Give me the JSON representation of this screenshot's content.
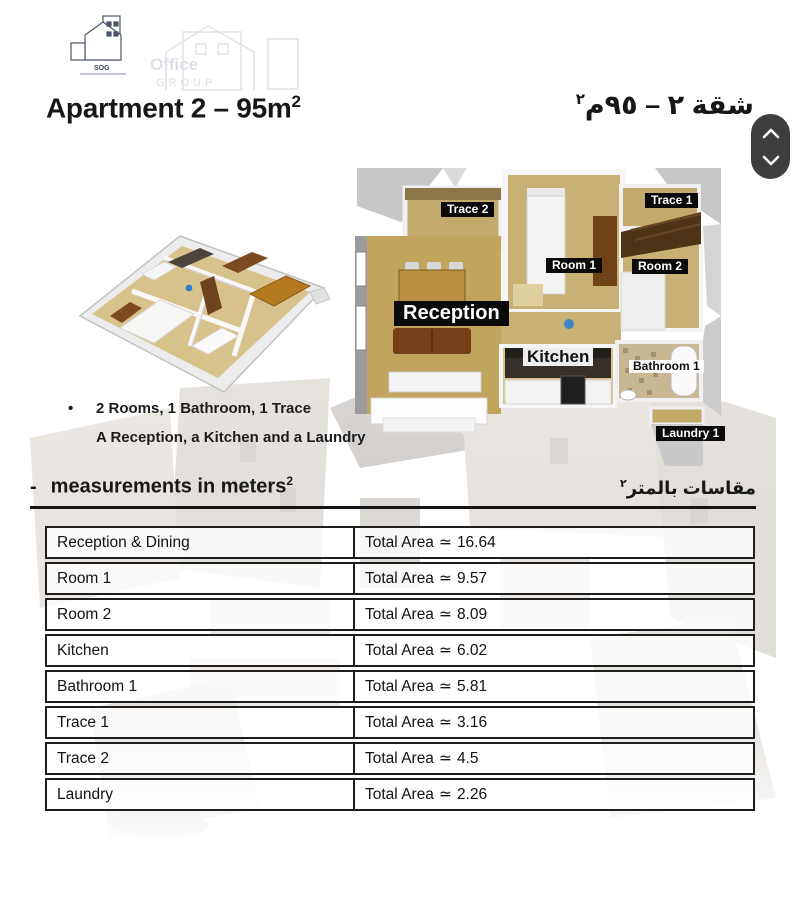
{
  "logo": {
    "abbr": "SOG",
    "watermark_line1": "Office",
    "watermark_line2": "GROUP"
  },
  "header": {
    "title_en": "Apartment 2 – 95m",
    "title_en_sup": "2",
    "title_ar": "شقة ٢ – ٩٥م",
    "title_ar_sup": "٢"
  },
  "icons": {
    "scroll_up": "chevron-up",
    "scroll_down": "chevron-down"
  },
  "plan": {
    "labels": {
      "trace2": "Trace 2",
      "trace1": "Trace 1",
      "room1": "Room 1",
      "room2": "Room 2",
      "reception": "Reception",
      "kitchen": "Kitchen",
      "bathroom1": "Bathroom 1",
      "laundry1": "Laundry 1"
    }
  },
  "features": {
    "bullet": "•",
    "lines": [
      "2 Rooms, 1 Bathroom, 1 Trace",
      "A Reception, a Kitchen and a Laundry"
    ]
  },
  "measurements_header": {
    "dash": "-",
    "en": "measurements in meters",
    "en_sup": "2",
    "ar": "مقاسات بالمتر",
    "ar_sup": "٢"
  },
  "table": {
    "area_label": "Total Area",
    "approx_symbol": "≃",
    "rows": [
      {
        "room": "Reception & Dining",
        "value": "16.64"
      },
      {
        "room": "Room 1",
        "value": "9.57"
      },
      {
        "room": "Room 2",
        "value": "8.09"
      },
      {
        "room": "Kitchen",
        "value": "6.02"
      },
      {
        "room": "Bathroom 1",
        "value": "5.81"
      },
      {
        "room": "Trace 1",
        "value": "3.16"
      },
      {
        "room": "Trace 2",
        "value": "4.5"
      },
      {
        "room": "Laundry",
        "value": "2.26"
      }
    ]
  },
  "colors": {
    "label_dark_bg": "#0a0a0a",
    "scroll_pill_bg": "#3e3e3e",
    "table_border": "#1e1e1e",
    "floor_tan": "#c9b075"
  }
}
